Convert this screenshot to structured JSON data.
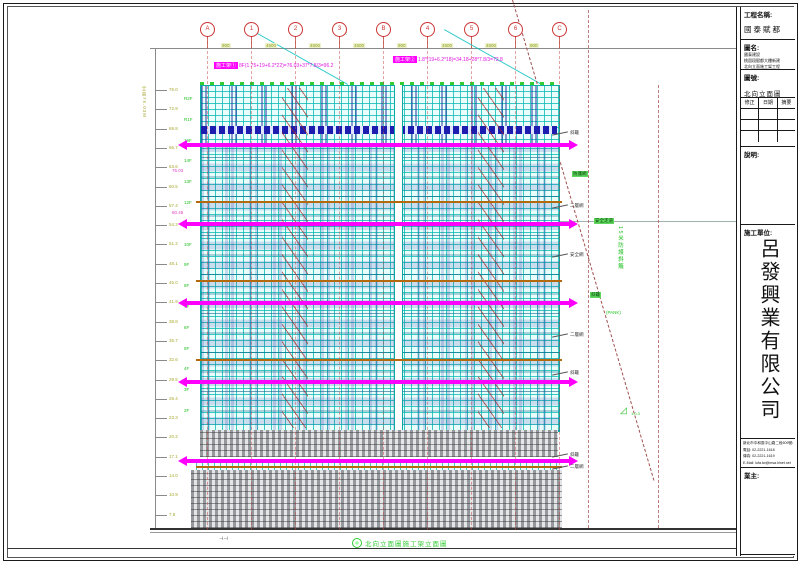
{
  "colors": {
    "scaffold_cyan": "#09a9a4",
    "safety_magenta": "#ff00ff",
    "tie_orange": "#b4690e",
    "grid_red": "#cc4444",
    "annotation_green": "#23c023",
    "level_olive": "#a8a832",
    "window_blue": "#1d1db0",
    "mesh_gray": "#95999d"
  },
  "title_block": {
    "project_label": "工程名稱:",
    "project_name": "國泰賦都",
    "drawing_name_label": "圖名:",
    "drawing_name_lines": [
      "國泰建設",
      "桃園段賦都大樓新建",
      "北向立面施工架工程"
    ],
    "drawing_no_label": "圖號:",
    "drawing_no": "北向立面圖",
    "revision_headers": [
      "修正",
      "日期",
      "摘要"
    ],
    "notes_label": "說明:",
    "contractor_label": "施工單位:",
    "company_name": "呂發興業有限公司",
    "contact_lines": [
      "新北市中和區中山路二段609號4樓",
      "電話: 02-2221-1618",
      "傳真: 02-2221-1619",
      "E-Mail: lufa.tw@msa.hinet.net"
    ],
    "owner_label": "業主:"
  },
  "drawing": {
    "grid_bubbles": [
      "A",
      "1",
      "2",
      "3",
      "B",
      "4",
      "5",
      "6",
      "C"
    ],
    "dim_labels": [
      "900",
      "4500",
      "4500",
      "4500",
      "900",
      "4500",
      "4500",
      "900"
    ],
    "ruler_labels": [
      "76.0",
      "72.9",
      "69.8",
      "66.7",
      "63.6",
      "60.5",
      "57.4",
      "54.3",
      "51.2",
      "48.1",
      "45.0",
      "41.9",
      "38.8",
      "35.7",
      "32.6",
      "29.5",
      "26.4",
      "23.3",
      "20.2",
      "17.1",
      "14.0",
      "10.9",
      "7.8"
    ],
    "ruler_title": "全高76.03M",
    "floor_labels": [
      "R2F",
      "R1F",
      "15F",
      "14F",
      "13F",
      "12F",
      "11F",
      "10F",
      "9F",
      "8F",
      "7F",
      "6F",
      "5F",
      "4F",
      "3F",
      "2F"
    ],
    "pink_labels": [
      "76.03",
      "60.45"
    ],
    "formula_left_tag": "施工架①",
    "formula_left": "8F(1.75+19+6.2*22)=76.03+37*7.8/3=96.2",
    "formula_right_tag": "施工架②",
    "formula_right": "1.8*(19+6.2*18)=34.18+28*7.8/3=72.8",
    "roof_note": "屋突",
    "right_labels": [
      "斜籬",
      "二層網",
      "安全網",
      "二層網",
      "斜籬",
      "斜籬",
      "二層網"
    ],
    "right_green_labels": [
      "防護網",
      "安全走道",
      "斜籬"
    ],
    "side_vertical_note": "15米防護斜籬",
    "side_vertical_suffix": "(PANK)",
    "slope_label": "1:0.3",
    "stamp_text": "北向立面圖施工架立面圖",
    "ground_note": "⊣⊣"
  }
}
